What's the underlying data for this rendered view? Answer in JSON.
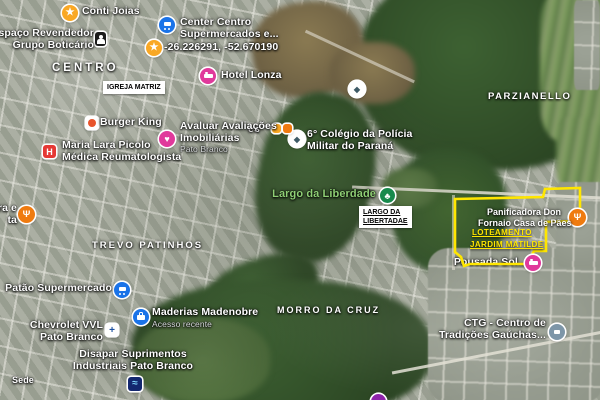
{
  "map": {
    "region_labels": {
      "centro": "CENTRO",
      "parzianello": "PARZIANELLO",
      "trevo_patinhos": "TREVO PATINHOS",
      "morro_da_cruz": "MORRO DA CRUZ",
      "sede": "Sede",
      "partial_es": "es"
    },
    "boxed_labels": {
      "igreja_matriz": "IGREJA MATRIZ",
      "largo_line1": "LARGO DA",
      "largo_line2": "LIBERTADAE"
    },
    "pois": {
      "conti_joias": {
        "label": "Conti Joias"
      },
      "grupo_boticario": {
        "line1": "Espaço Revendedor",
        "line2": "Grupo Boticário"
      },
      "center_centro": {
        "line1": "Center Centro",
        "line2": "Supermercados e..."
      },
      "dropped_pin": {
        "label": "-26.226291, -52.670190"
      },
      "hotel_lonza": {
        "label": "Hotel Lonza"
      },
      "burger_king": {
        "label": "Burger King"
      },
      "maria_lara": {
        "line1": "Maria Lara Picolo",
        "line2": "Médica Reumatologista"
      },
      "avaluar": {
        "line1": "Avaluar Avaliações",
        "line2": "Imobiliárias",
        "sub": "Pato Branco"
      },
      "colegio_policia": {
        "line1": "6° Colégio da Polícia",
        "line2": "Militar do Paraná"
      },
      "largo_liberdade_park": {
        "label": "Largo da Liberdade"
      },
      "patao": {
        "label": "Patão Supermercado"
      },
      "madenobre": {
        "label": "Maderias Madenobre",
        "sub": "Acesso recente"
      },
      "chevrolet": {
        "line1": "Chevrolet VVL",
        "line2": "Pato Branco"
      },
      "disapar": {
        "line1": "Disapar Suprimentos",
        "line2": "Industriais Pato Branco"
      },
      "left_restaurant": {
        "line1": "ra e",
        "line2": "ta"
      },
      "pousada": {
        "label": "Pousada Sol..."
      },
      "ctg": {
        "line1": "CTG - Centro de",
        "line2": "Tradições Gaúchas..."
      }
    },
    "overlay": {
      "panificadora_line1": "Panificadora Don",
      "panificadora_line2": "Fornaio Casa de Pães",
      "loteamento_line1": "LOTEAMENTO",
      "loteamento_line2": "JARDIM MATILDE",
      "outline_color": "#ffe600"
    },
    "colors": {
      "marker_blue": "#1a73e8",
      "marker_yellow": "#f9a825",
      "marker_pink": "#e0399b",
      "marker_red": "#e53935",
      "marker_orange": "#ef7b10",
      "marker_green": "#188a4c",
      "marker_slate": "#7d96a8",
      "marker_navy": "#13276f",
      "marker_purple": "#8e24aa",
      "park_label_green": "#8fcf75"
    }
  }
}
